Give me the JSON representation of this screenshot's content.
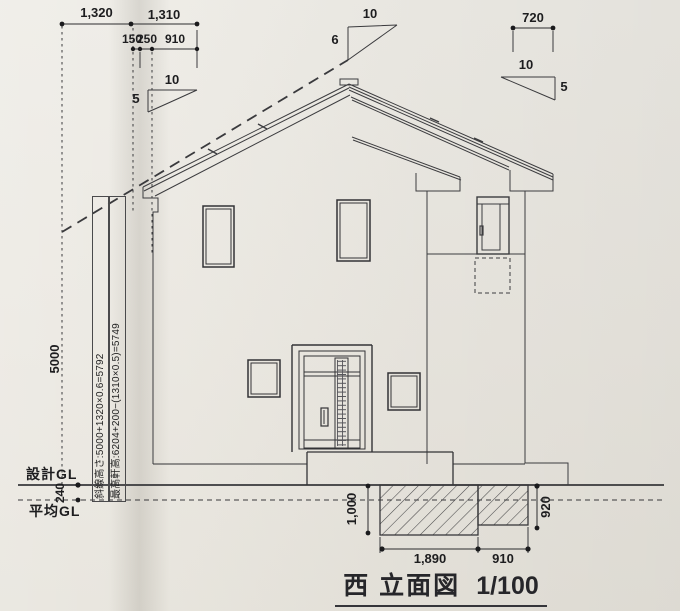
{
  "drawing": {
    "title": {
      "text": "西 立面図",
      "scale": "1/100"
    },
    "top_dims": {
      "d1320": "1,320",
      "d1310": "1,310",
      "d150": "150",
      "d250": "250",
      "d910": "910",
      "d720": "720"
    },
    "slope_marks": {
      "left": {
        "run": "10",
        "rise": "5"
      },
      "middle": {
        "run": "10",
        "rise": "6"
      },
      "right": {
        "run": "10",
        "rise": "5"
      }
    },
    "left_side": {
      "boundary_height": "5000",
      "gl_offset": "240",
      "design_gl": "設計GL",
      "average_gl": "平均GL",
      "formula_slope_height": "斜線高さ:5000+1320×0.6=5792",
      "formula_max_eave_height": "最高軒高:6204+200−(1310×0.5)=5749"
    },
    "bottom_dims": {
      "depth_left": "1,000",
      "depth_right": "920",
      "width_left": "1,890",
      "width_right": "910"
    }
  }
}
